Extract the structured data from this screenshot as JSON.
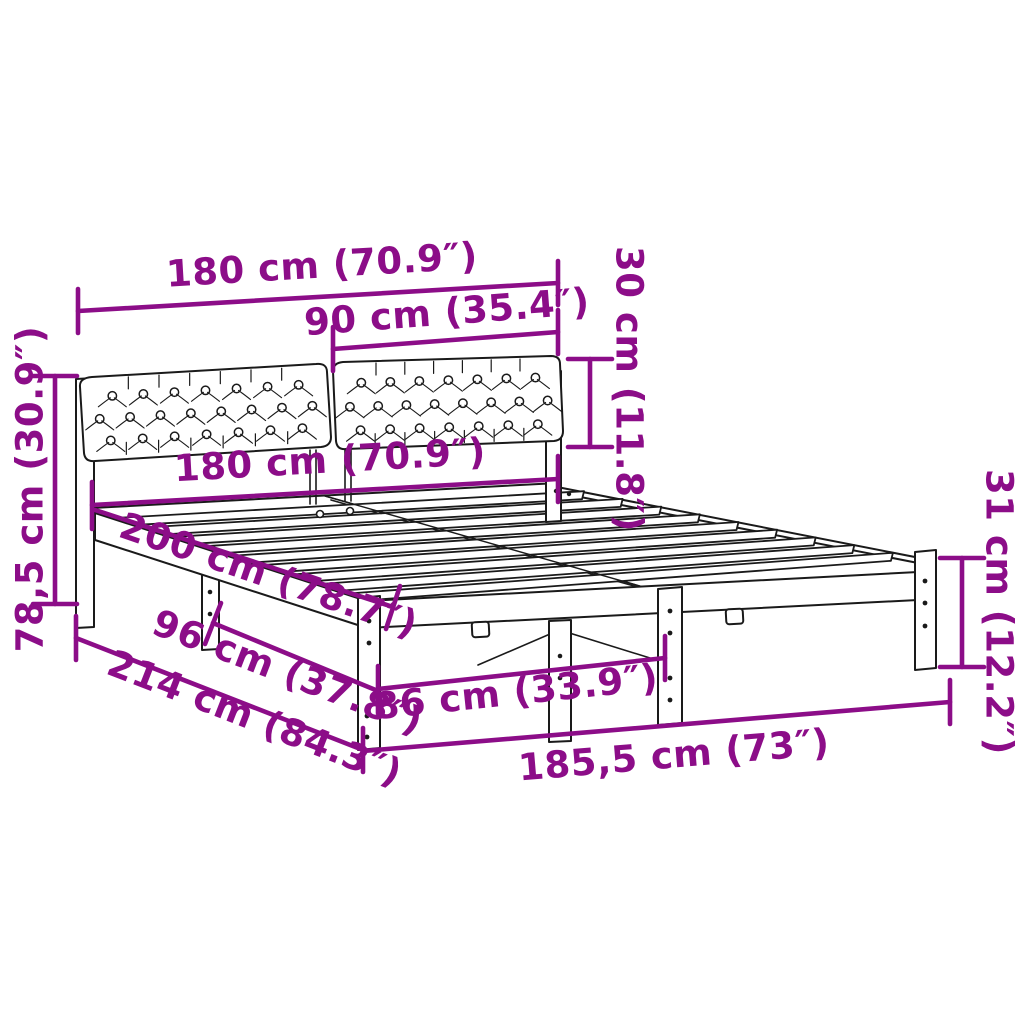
{
  "diagram": {
    "type": "product-dimension-diagram",
    "subject": "bed-frame-with-tufted-headboard",
    "colors": {
      "dimension_accent": "#8c0d88",
      "outline": "#1a1a1a",
      "background": "#ffffff"
    },
    "labels": {
      "headboard_total_width": "180 cm (70.9″)",
      "cushion_width": "90 cm (35.4″)",
      "cushion_height": "30 cm (11.8″)",
      "headboard_height": "78,5 cm (30.9″)",
      "bed_width": "180 cm (70.9″)",
      "bed_length": "200 cm (78.7″)",
      "side_leg_spacing": "96 cm (37.8″)",
      "overall_length": "214 cm (84.3″)",
      "front_leg_spacing": "86 cm (33.9″)",
      "frame_outer_width": "185,5 cm (73″)",
      "leg_height": "31 cm (12.2″)"
    }
  }
}
